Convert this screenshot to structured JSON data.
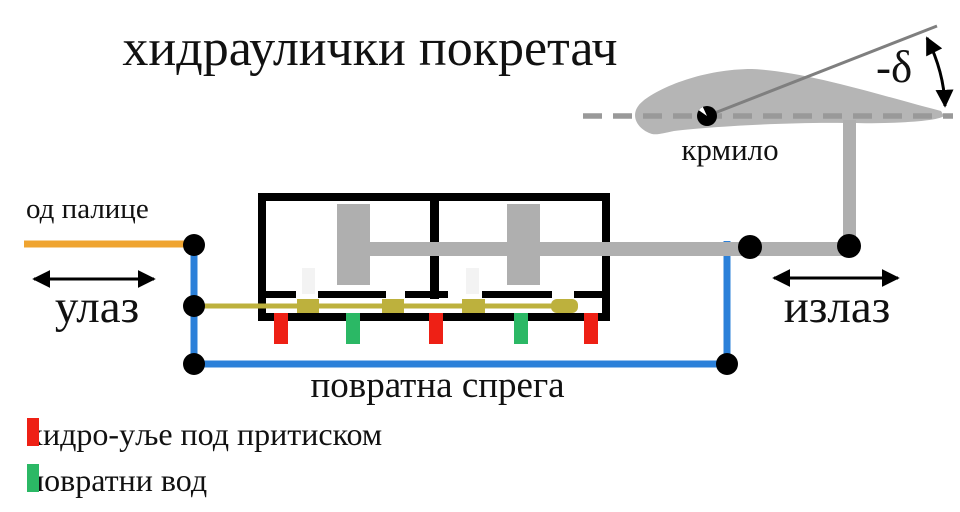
{
  "title": "хидраулички покретач",
  "diagram": {
    "from_stick_label": "од палице",
    "input_label": "улаз",
    "output_label": "излаз",
    "feedback_label": "повратна спрега",
    "rudder_label": "крмило",
    "deflection_label": "-δ"
  },
  "legend": {
    "items": [
      {
        "label": "хидро-уље под притиском",
        "color_name": "red"
      },
      {
        "label": "повратни вод",
        "color_name": "green"
      }
    ]
  },
  "colors": {
    "red": "#EE2015",
    "green": "#2BB865",
    "orange": "#EFA430",
    "blue": "#2B80D9",
    "olive": "#BDB13D",
    "part_gray": "#AFAFAF",
    "airfoil_gray": "#B5B5B5",
    "centerline_gray": "#999999",
    "thin_line_gray": "#7F7F7F",
    "black": "#000000"
  }
}
